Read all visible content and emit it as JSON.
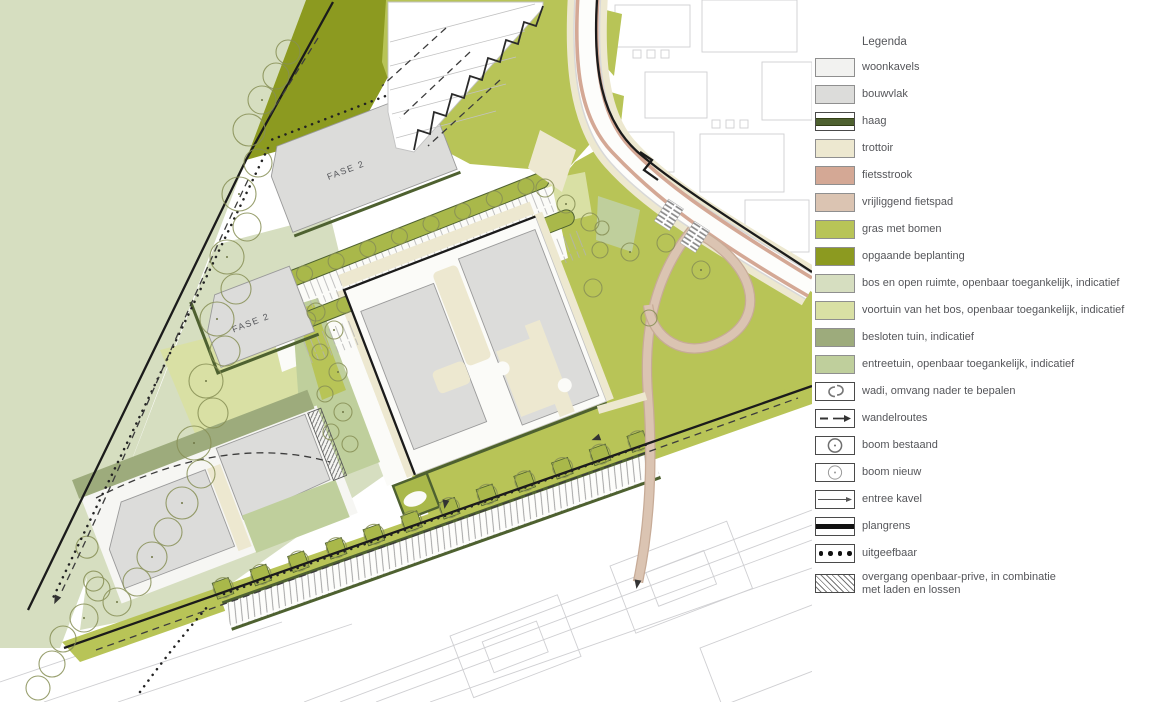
{
  "map": {
    "labels": [
      {
        "text": "FASE 2"
      },
      {
        "text": "FASE 2"
      }
    ],
    "palette": {
      "bos_en_open_ruimte": "#d6dec0",
      "opgaande_beplanting": "#8c9a20",
      "gras_met_bomen": "#b8c457",
      "voortuin_van_het_bos": "#d9e0a4",
      "besloten_tuin": "#9dab7c",
      "entreetuin": "#bfcf9c",
      "woonkavels": "#f2f2f0",
      "bouwvlak": "#dcdcda",
      "trottoir": "#ede8d0",
      "fietsstrook": "#d4a895",
      "vrijliggend_fietspad": "#dbc4b2",
      "haag": "#4e6130",
      "plangrens": "#111111",
      "context_lines": "#cfcfd2"
    }
  },
  "legend": {
    "title": "Legenda",
    "items": [
      {
        "label": "woonkavels",
        "symbol": "fill",
        "color": "#f2f2f0"
      },
      {
        "label": "bouwvlak",
        "symbol": "fill",
        "color": "#dcdcda"
      },
      {
        "label": "haag",
        "symbol": "haag",
        "color": "#4e6130"
      },
      {
        "label": "trottoir",
        "symbol": "fill",
        "color": "#ede8d0"
      },
      {
        "label": "fietsstrook",
        "symbol": "fill",
        "color": "#d4a895"
      },
      {
        "label": "vrijliggend fietspad",
        "symbol": "fill",
        "color": "#dbc4b2"
      },
      {
        "label": "gras met bomen",
        "symbol": "fill",
        "color": "#b8c457"
      },
      {
        "label": "opgaande beplanting",
        "symbol": "fill",
        "color": "#8c9a20"
      },
      {
        "label": "bos en open ruimte, openbaar toegankelijk, indicatief",
        "symbol": "fill",
        "color": "#d6dec0"
      },
      {
        "label": "voortuin van het bos, openbaar toegankelijk, indicatief",
        "symbol": "fill",
        "color": "#d9e0a4"
      },
      {
        "label": "besloten tuin, indicatief",
        "symbol": "fill",
        "color": "#9dab7c"
      },
      {
        "label": "entreetuin, openbaar toegankelijk,  indicatief",
        "symbol": "fill",
        "color": "#bfcf9c"
      },
      {
        "label": "wadi, omvang nader te bepalen",
        "symbol": "wadi"
      },
      {
        "label": "wandelroutes",
        "symbol": "dash-arrow"
      },
      {
        "label": "boom bestaand",
        "symbol": "tree-existing"
      },
      {
        "label": "boom nieuw",
        "symbol": "tree-new"
      },
      {
        "label": "entree kavel",
        "symbol": "entry-arrow"
      },
      {
        "label": "plangrens",
        "symbol": "boundary-line",
        "color": "#111111"
      },
      {
        "label": "uitgeefbaar",
        "symbol": "dots"
      },
      {
        "label": "overgang openbaar-prive, in combinatie",
        "label2": "met laden en lossen",
        "symbol": "hatch"
      }
    ]
  }
}
